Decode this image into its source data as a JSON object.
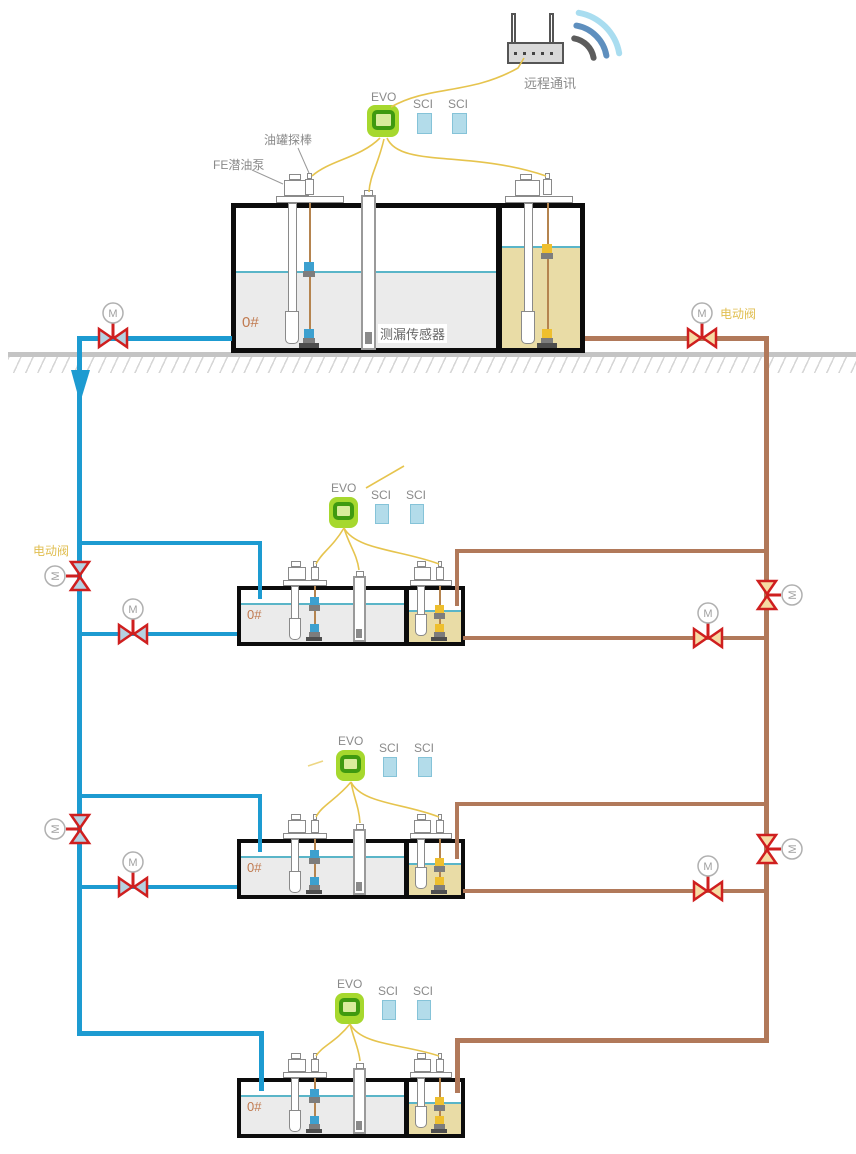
{
  "router": {
    "label": "远程通讯"
  },
  "stations": [
    {
      "controller": "EVO",
      "modules": [
        "SCI",
        "SCI"
      ],
      "fuel_grade": "0#",
      "annotations": {
        "tank_probe": "油罐探棒",
        "pump": "FE潜油泵",
        "leak_sensor": "测漏传感器",
        "motor_valve": "电动阀"
      }
    },
    {
      "controller": "EVO",
      "modules": [
        "SCI",
        "SCI"
      ],
      "fuel_grade": "0#",
      "annotations": {
        "motor_valve": "电动阀"
      }
    },
    {
      "controller": "EVO",
      "modules": [
        "SCI",
        "SCI"
      ],
      "fuel_grade": "0#"
    },
    {
      "controller": "EVO",
      "modules": [
        "SCI",
        "SCI"
      ],
      "fuel_grade": "0#"
    }
  ],
  "valves": {
    "motor_symbol": "M"
  },
  "colors": {
    "supply_pipe_blue": "#1d9bd1",
    "return_pipe_brown": "#b1795a",
    "signal_wire_yellow": "#e6c44e",
    "valve_red": "#cf1f1f",
    "evo_green": "#a6d82e",
    "sci_blue": "#b3dcea",
    "diesel_liquid_gray": "#ebebeb",
    "oil_liquid_tan": "#e9dca6"
  }
}
